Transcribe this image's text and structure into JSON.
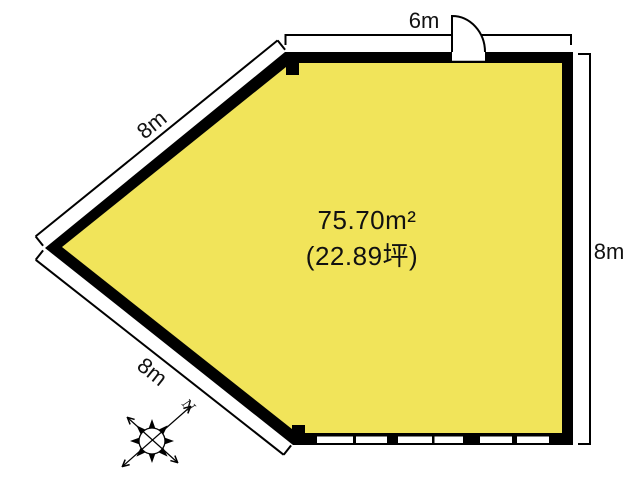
{
  "floor_plan": {
    "area": {
      "square_meters": "75.70m²",
      "tsubo": "(22.89坪)"
    },
    "dimensions": {
      "top_wall": "6m",
      "right_wall": "8m",
      "upper_left_wall": "8m",
      "lower_left_wall": "8m"
    },
    "compass": {
      "north_label": "N"
    },
    "colors": {
      "room_fill": "#F1E45A",
      "wall": "#000000",
      "line": "#000000",
      "background": "#FFFFFF",
      "text": "#111111"
    }
  }
}
